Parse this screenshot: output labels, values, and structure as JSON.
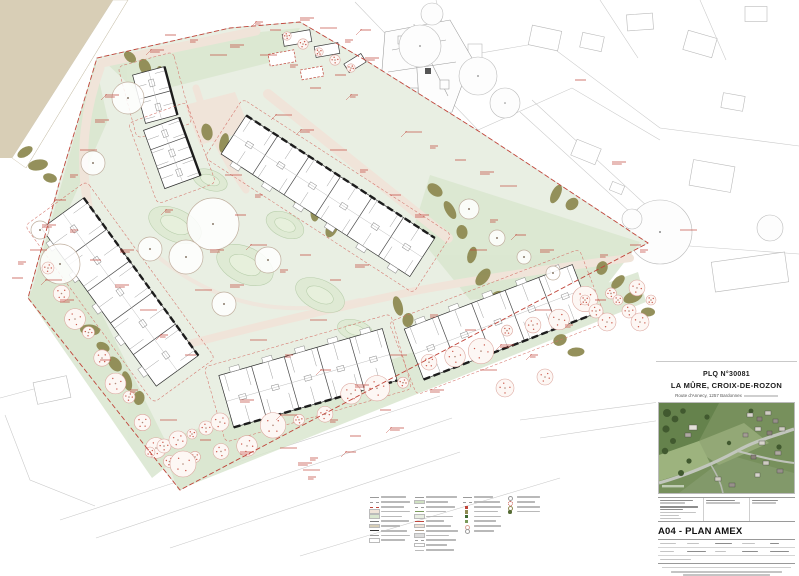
{
  "sheet": {
    "project_number": "PLQ N°30081",
    "project_name": "LA MÛRE, CROIX-DE-ROZON",
    "project_address": "Route d'Annecy, 1257 Bardonnex",
    "drawing_title": "A04 - PLAN AMEX"
  },
  "colors": {
    "annotation_red": "#c0453a",
    "site_green": "#e9efe3",
    "lawn_green": "#d9e6cf",
    "hedge_olive": "#8f8b53",
    "path_pink": "#f0e4d9",
    "terrain_tan": "#d8ceb6",
    "wall_black": "#1c1c1c",
    "parcel_gray": "#c8c8c8"
  },
  "plan": {
    "description": "Site plan with five residential buildings around a central landscaped courtyard, orchard tree bands along the south-west and south-east boundaries, red PLQ boundary and construction-limit dashed lines, existing farm cluster and neighbouring parcels drawn in thin grey lines."
  },
  "legend": {
    "note": "micro-print legend (illegible at this scale)",
    "column_entry_counts": [
      10,
      12,
      8,
      4
    ]
  }
}
